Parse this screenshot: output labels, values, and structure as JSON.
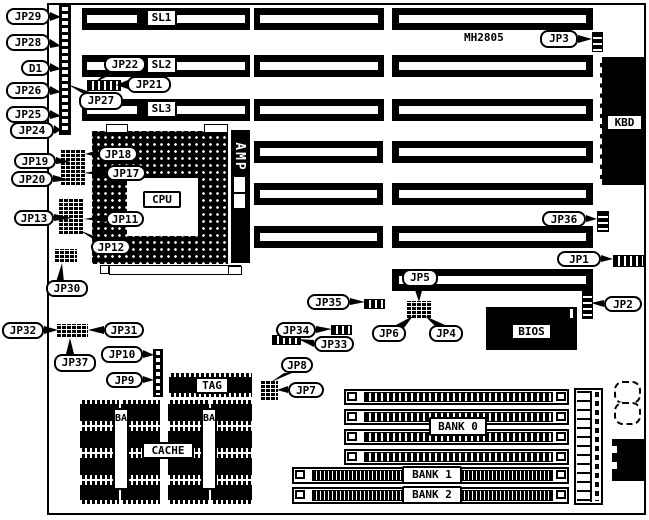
{
  "diagram": {
    "model": "MH2805",
    "callouts": {
      "jp29": "JP29",
      "jp28": "JP28",
      "d1": "D1",
      "jp26": "JP26",
      "jp25": "JP25",
      "jp24": "JP24",
      "jp27": "JP27",
      "jp22": "JP22",
      "jp21": "JP21",
      "jp19": "JP19",
      "jp20": "JP20",
      "jp18": "JP18",
      "jp17": "JP17",
      "jp13": "JP13",
      "jp11": "JP11",
      "jp12": "JP12",
      "jp30": "JP30",
      "jp3": "JP3",
      "jp36": "JP36",
      "jp1": "JP1",
      "jp2": "JP2",
      "jp5": "JP5",
      "jp6": "JP6",
      "jp4": "JP4",
      "jp35": "JP35",
      "jp34": "JP34",
      "jp33": "JP33",
      "jp8": "JP8",
      "jp7": "JP7",
      "jp32": "JP32",
      "jp31": "JP31",
      "jp37": "JP37",
      "jp10": "JP10",
      "jp9": "JP9"
    },
    "slot_labels": {
      "sl1": "SL1",
      "sl2": "SL2",
      "sl3": "SL3"
    },
    "chips": {
      "cpu": "CPU",
      "amp": "AMP",
      "kbd": "KBD",
      "bios": "BIOS",
      "tag": "TAG",
      "cache": "CACHE"
    },
    "cache_banks": {
      "bank1": "BANK1",
      "bank0": "BANK0"
    },
    "simm_banks": {
      "bank0": "BANK 0",
      "bank1": "BANK 1",
      "bank2": "BANK 2"
    },
    "colors": {
      "ink": "#000000",
      "paper": "#ffffff"
    }
  }
}
